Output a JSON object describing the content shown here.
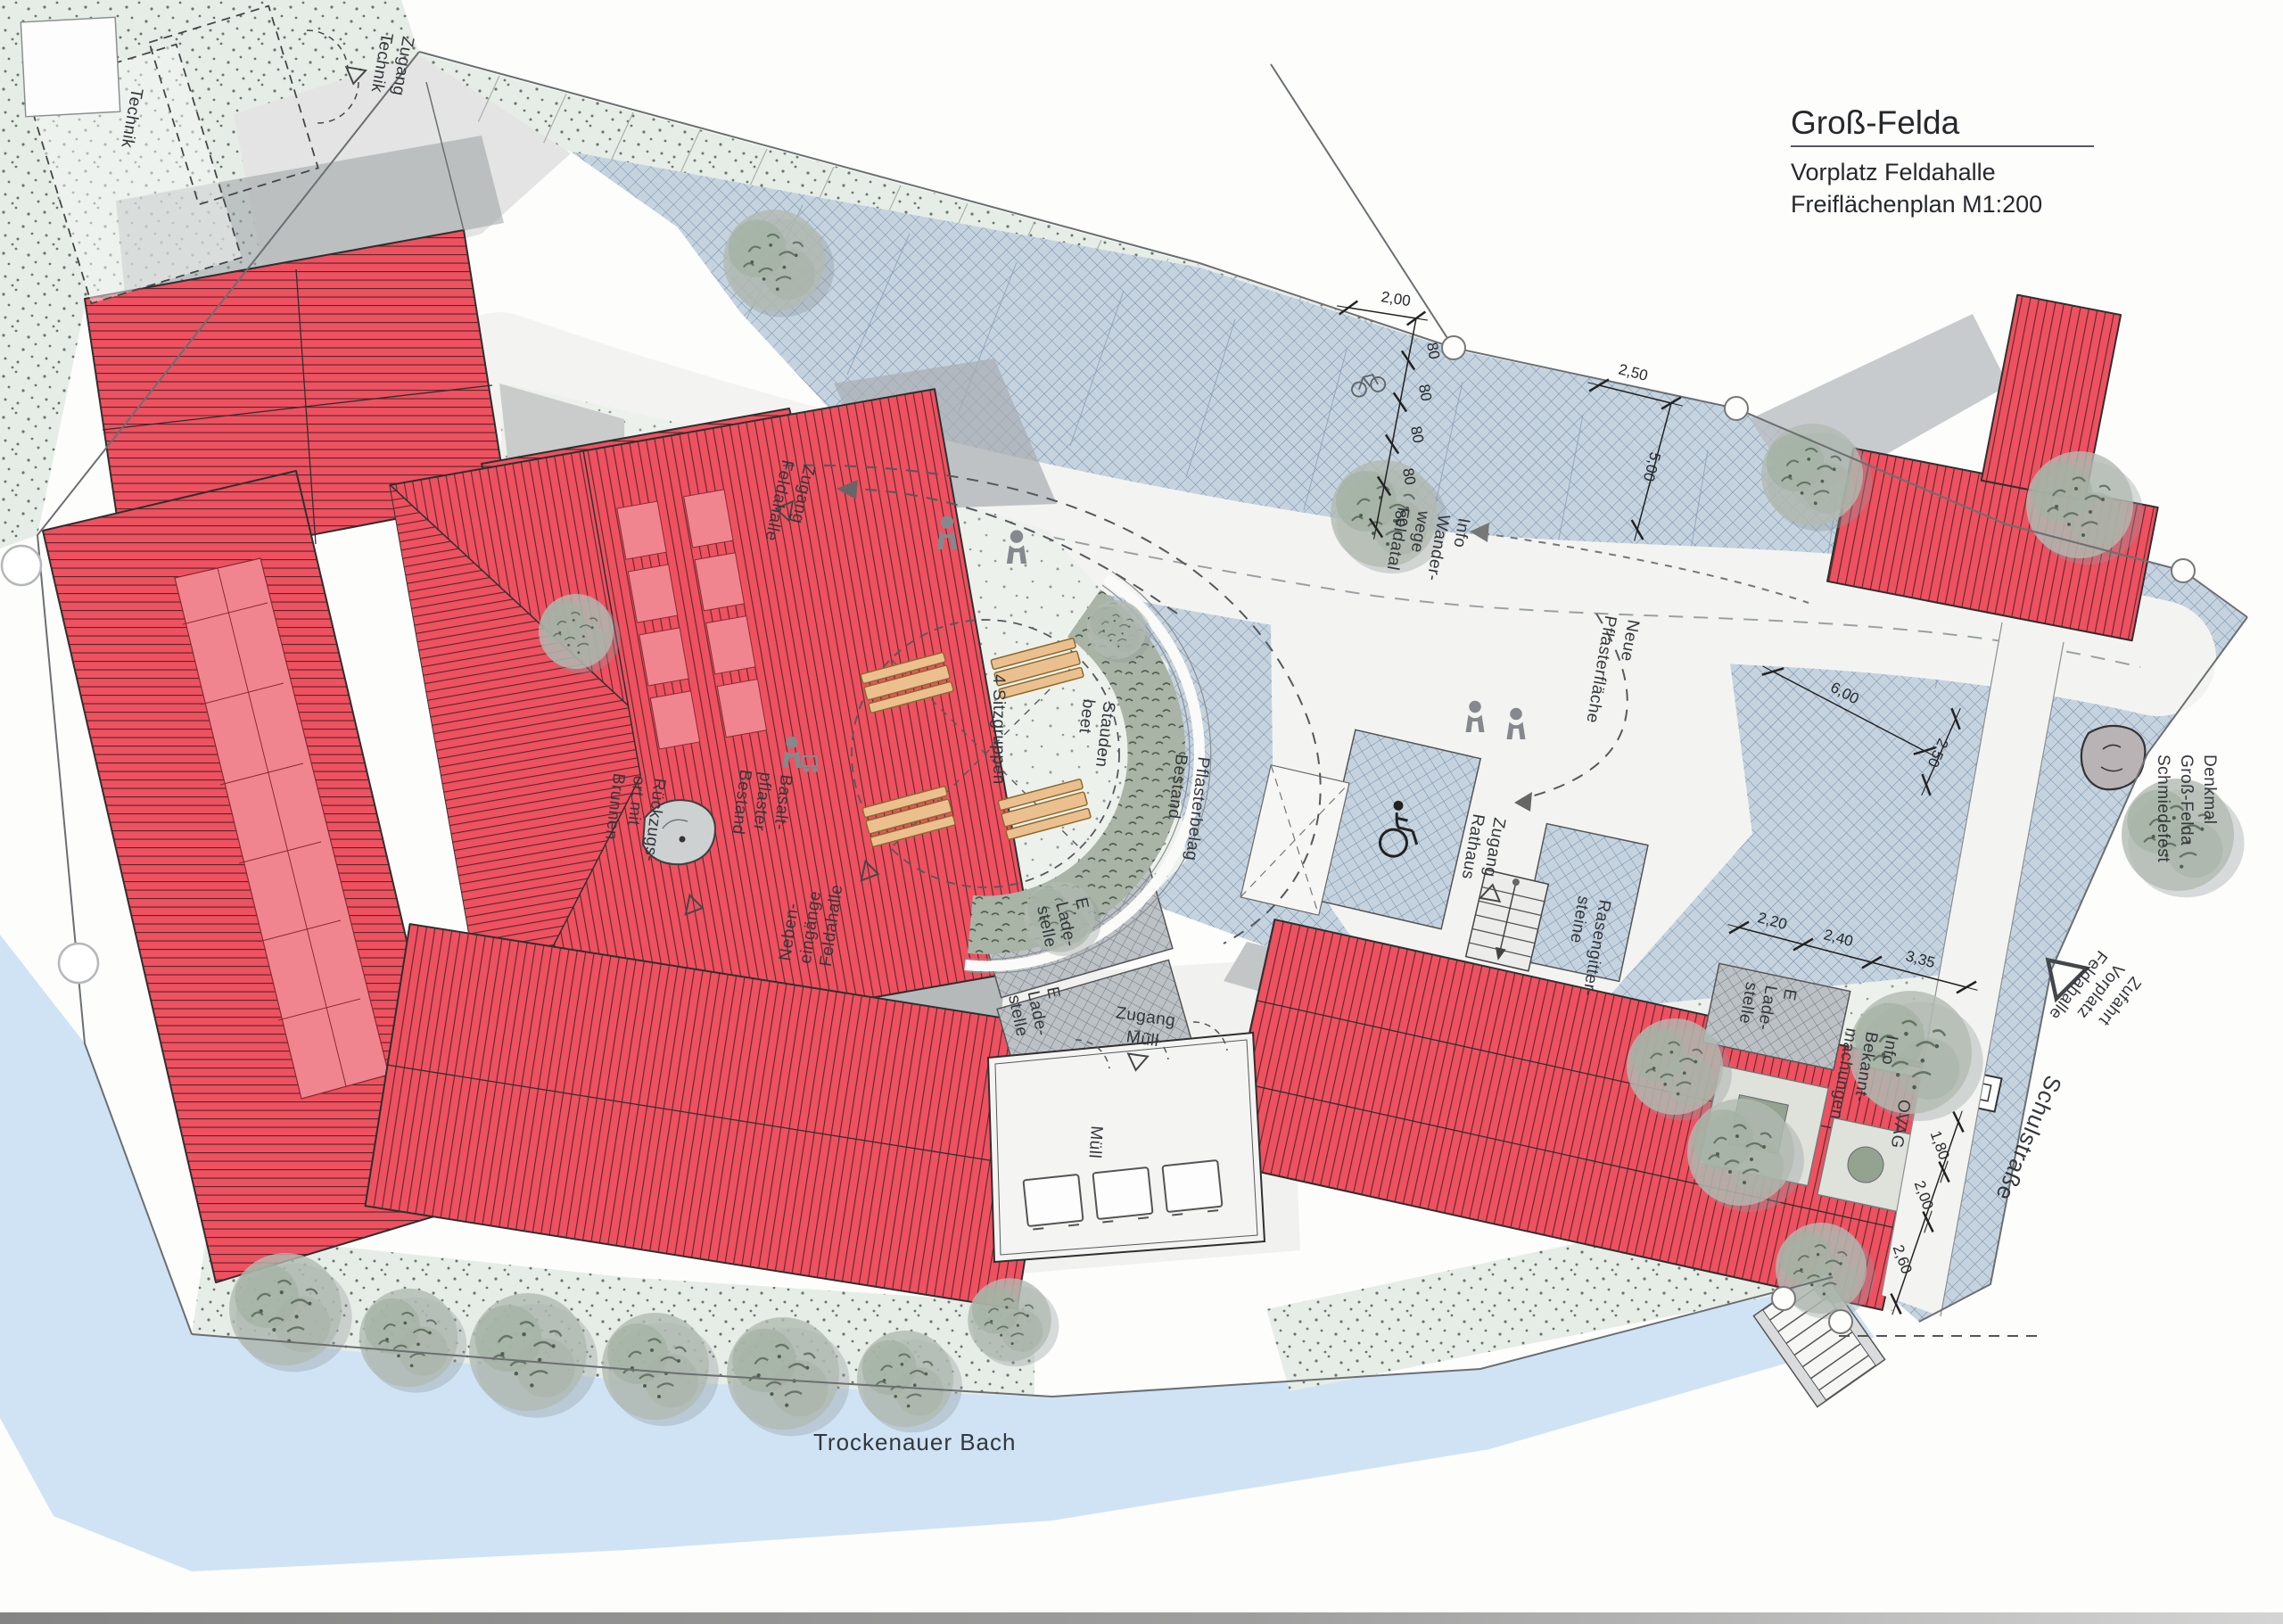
{
  "title_block": {
    "title": "Groß-Felda",
    "line1": "Vorplatz Feldahalle",
    "line2": "Freiflächenplan M1:200"
  },
  "labels": {
    "technik": "Technik",
    "zugang_technik": [
      "Zugang",
      "Technik"
    ],
    "zugang_feldahalle": [
      "Zugang",
      "Feldahalle"
    ],
    "sitzgruppen": "4 Sitzgruppen",
    "staudenbeet": [
      "Stauden",
      "beet"
    ],
    "rueckzugsort": [
      "Rückzugs-",
      "ort mit",
      "Brunnen"
    ],
    "basaltpflaster": [
      "Basalt-",
      "pflaster",
      "Bestand"
    ],
    "nebeneingaenge": [
      "Neben-",
      "eingänge",
      "Feldahalle"
    ],
    "ladestelle": [
      "E",
      "Lade-",
      "stelle"
    ],
    "zugang_muell": [
      "Zugang",
      "Müll"
    ],
    "muell": "Müll",
    "pflasterbelag": [
      "Pflasterbelag",
      "Bestand"
    ],
    "zugang_rathaus": [
      "Zugang",
      "Rathaus"
    ],
    "info_wanderwege": [
      "Info",
      "Wander-",
      "wege",
      "Feldatal"
    ],
    "neue_pflasterflaeche": [
      "Neue",
      "Pflasterfläche"
    ],
    "rasengittersteine": [
      "Rasengitter-",
      "steine"
    ],
    "info_bekanntmachungen": [
      "Info",
      "Bekannt-",
      "machungen"
    ],
    "ovag": "OVAG",
    "denkmal": [
      "Denkmal",
      "Groß-Felda",
      "Schmiedefest"
    ],
    "zufahrt": [
      "Zufahrt",
      "Vorplatz",
      "Feldahalle"
    ],
    "schulstrasse": "Schulstraße",
    "trockenauer_bach": "Trockenauer Bach"
  },
  "dimensions": {
    "d200": "2,00",
    "d80": "80",
    "d250a": "2,50",
    "d500": "5,00",
    "d600": "6,00",
    "d250b": "2,50",
    "d220": "2,20",
    "d240": "2,40",
    "d335": "3,35",
    "d180": "1,80",
    "d200b": "2,00",
    "d260": "2,60"
  },
  "colors": {
    "roof_red": "#ee5160",
    "roof_line": "#59272b",
    "paving_blue": "#c5d3df",
    "paving_line": "#7089a4",
    "water": "#cfe3f5",
    "grass": "#e6ede6",
    "basalt": "#b6b9ba"
  }
}
